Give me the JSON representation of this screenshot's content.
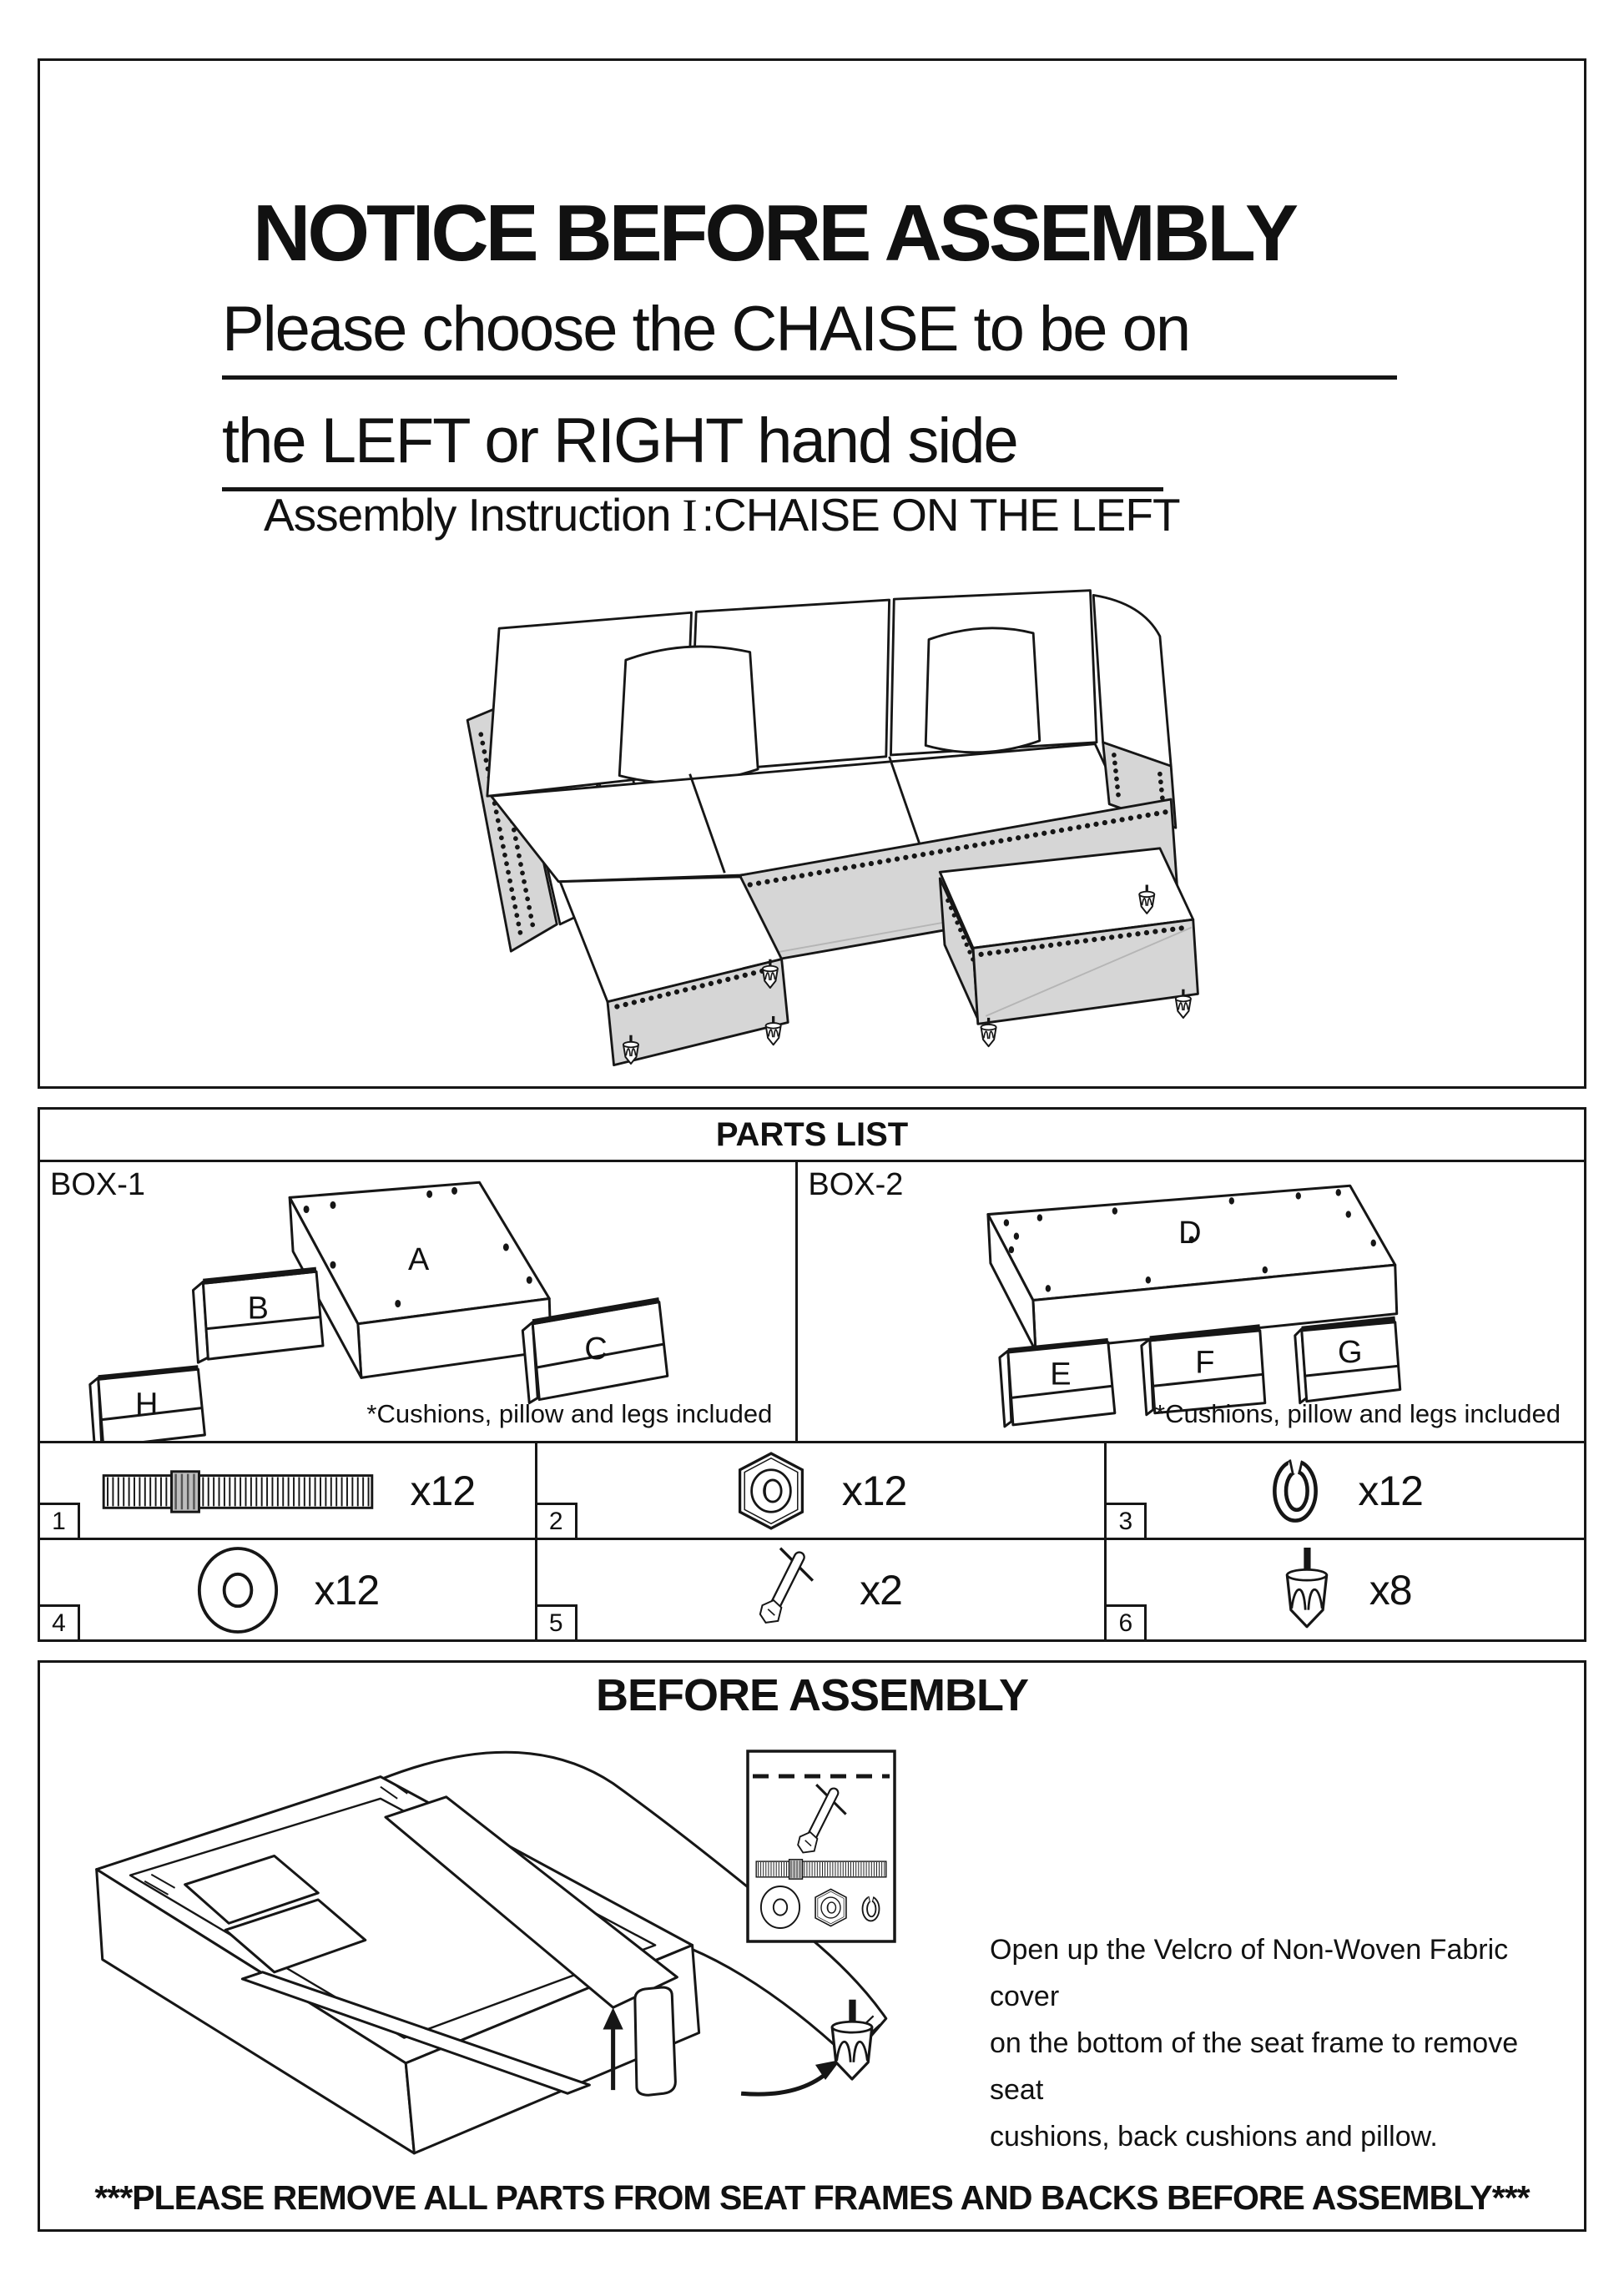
{
  "header": {
    "title": "NOTICE BEFORE ASSEMBLY",
    "subtitle_line1": "Please choose the CHAISE to be on",
    "subtitle_line2": "the LEFT or RIGHT hand side",
    "instruction_prefix": "Assembly Instruction",
    "instruction_numeral": "I",
    "instruction_suffix": ":CHAISE ON THE LEFT"
  },
  "parts_list": {
    "title": "PARTS LIST",
    "boxes": [
      {
        "label": "BOX-1",
        "parts": [
          "A",
          "B",
          "C",
          "H"
        ],
        "note": "*Cushions, pillow and legs included"
      },
      {
        "label": "BOX-2",
        "parts": [
          "D",
          "E",
          "F",
          "G"
        ],
        "note": "*Cushions, pillow and legs included"
      }
    ],
    "hardware": [
      {
        "num": "1",
        "qty": "x12",
        "icon": "bolt-icon"
      },
      {
        "num": "2",
        "qty": "x12",
        "icon": "hex-nut-icon"
      },
      {
        "num": "3",
        "qty": "x12",
        "icon": "lock-washer-icon"
      },
      {
        "num": "4",
        "qty": "x12",
        "icon": "flat-washer-icon"
      },
      {
        "num": "5",
        "qty": "x2",
        "icon": "wrench-icon"
      },
      {
        "num": "6",
        "qty": "x8",
        "icon": "leg-icon"
      }
    ]
  },
  "before_assembly": {
    "title": "BEFORE ASSEMBLY",
    "instruction_lines": [
      "Open up the Velcro of Non-Woven Fabric cover",
      "on the bottom of the seat frame to remove seat",
      "cushions, back cushions and pillow."
    ]
  },
  "footer_warning": "***PLEASE REMOVE ALL PARTS FROM SEAT FRAMES AND BACKS BEFORE ASSEMBLY***",
  "colors": {
    "line": "#161616",
    "base_gray": "#d6d6d6",
    "paper": "#ffffff"
  }
}
